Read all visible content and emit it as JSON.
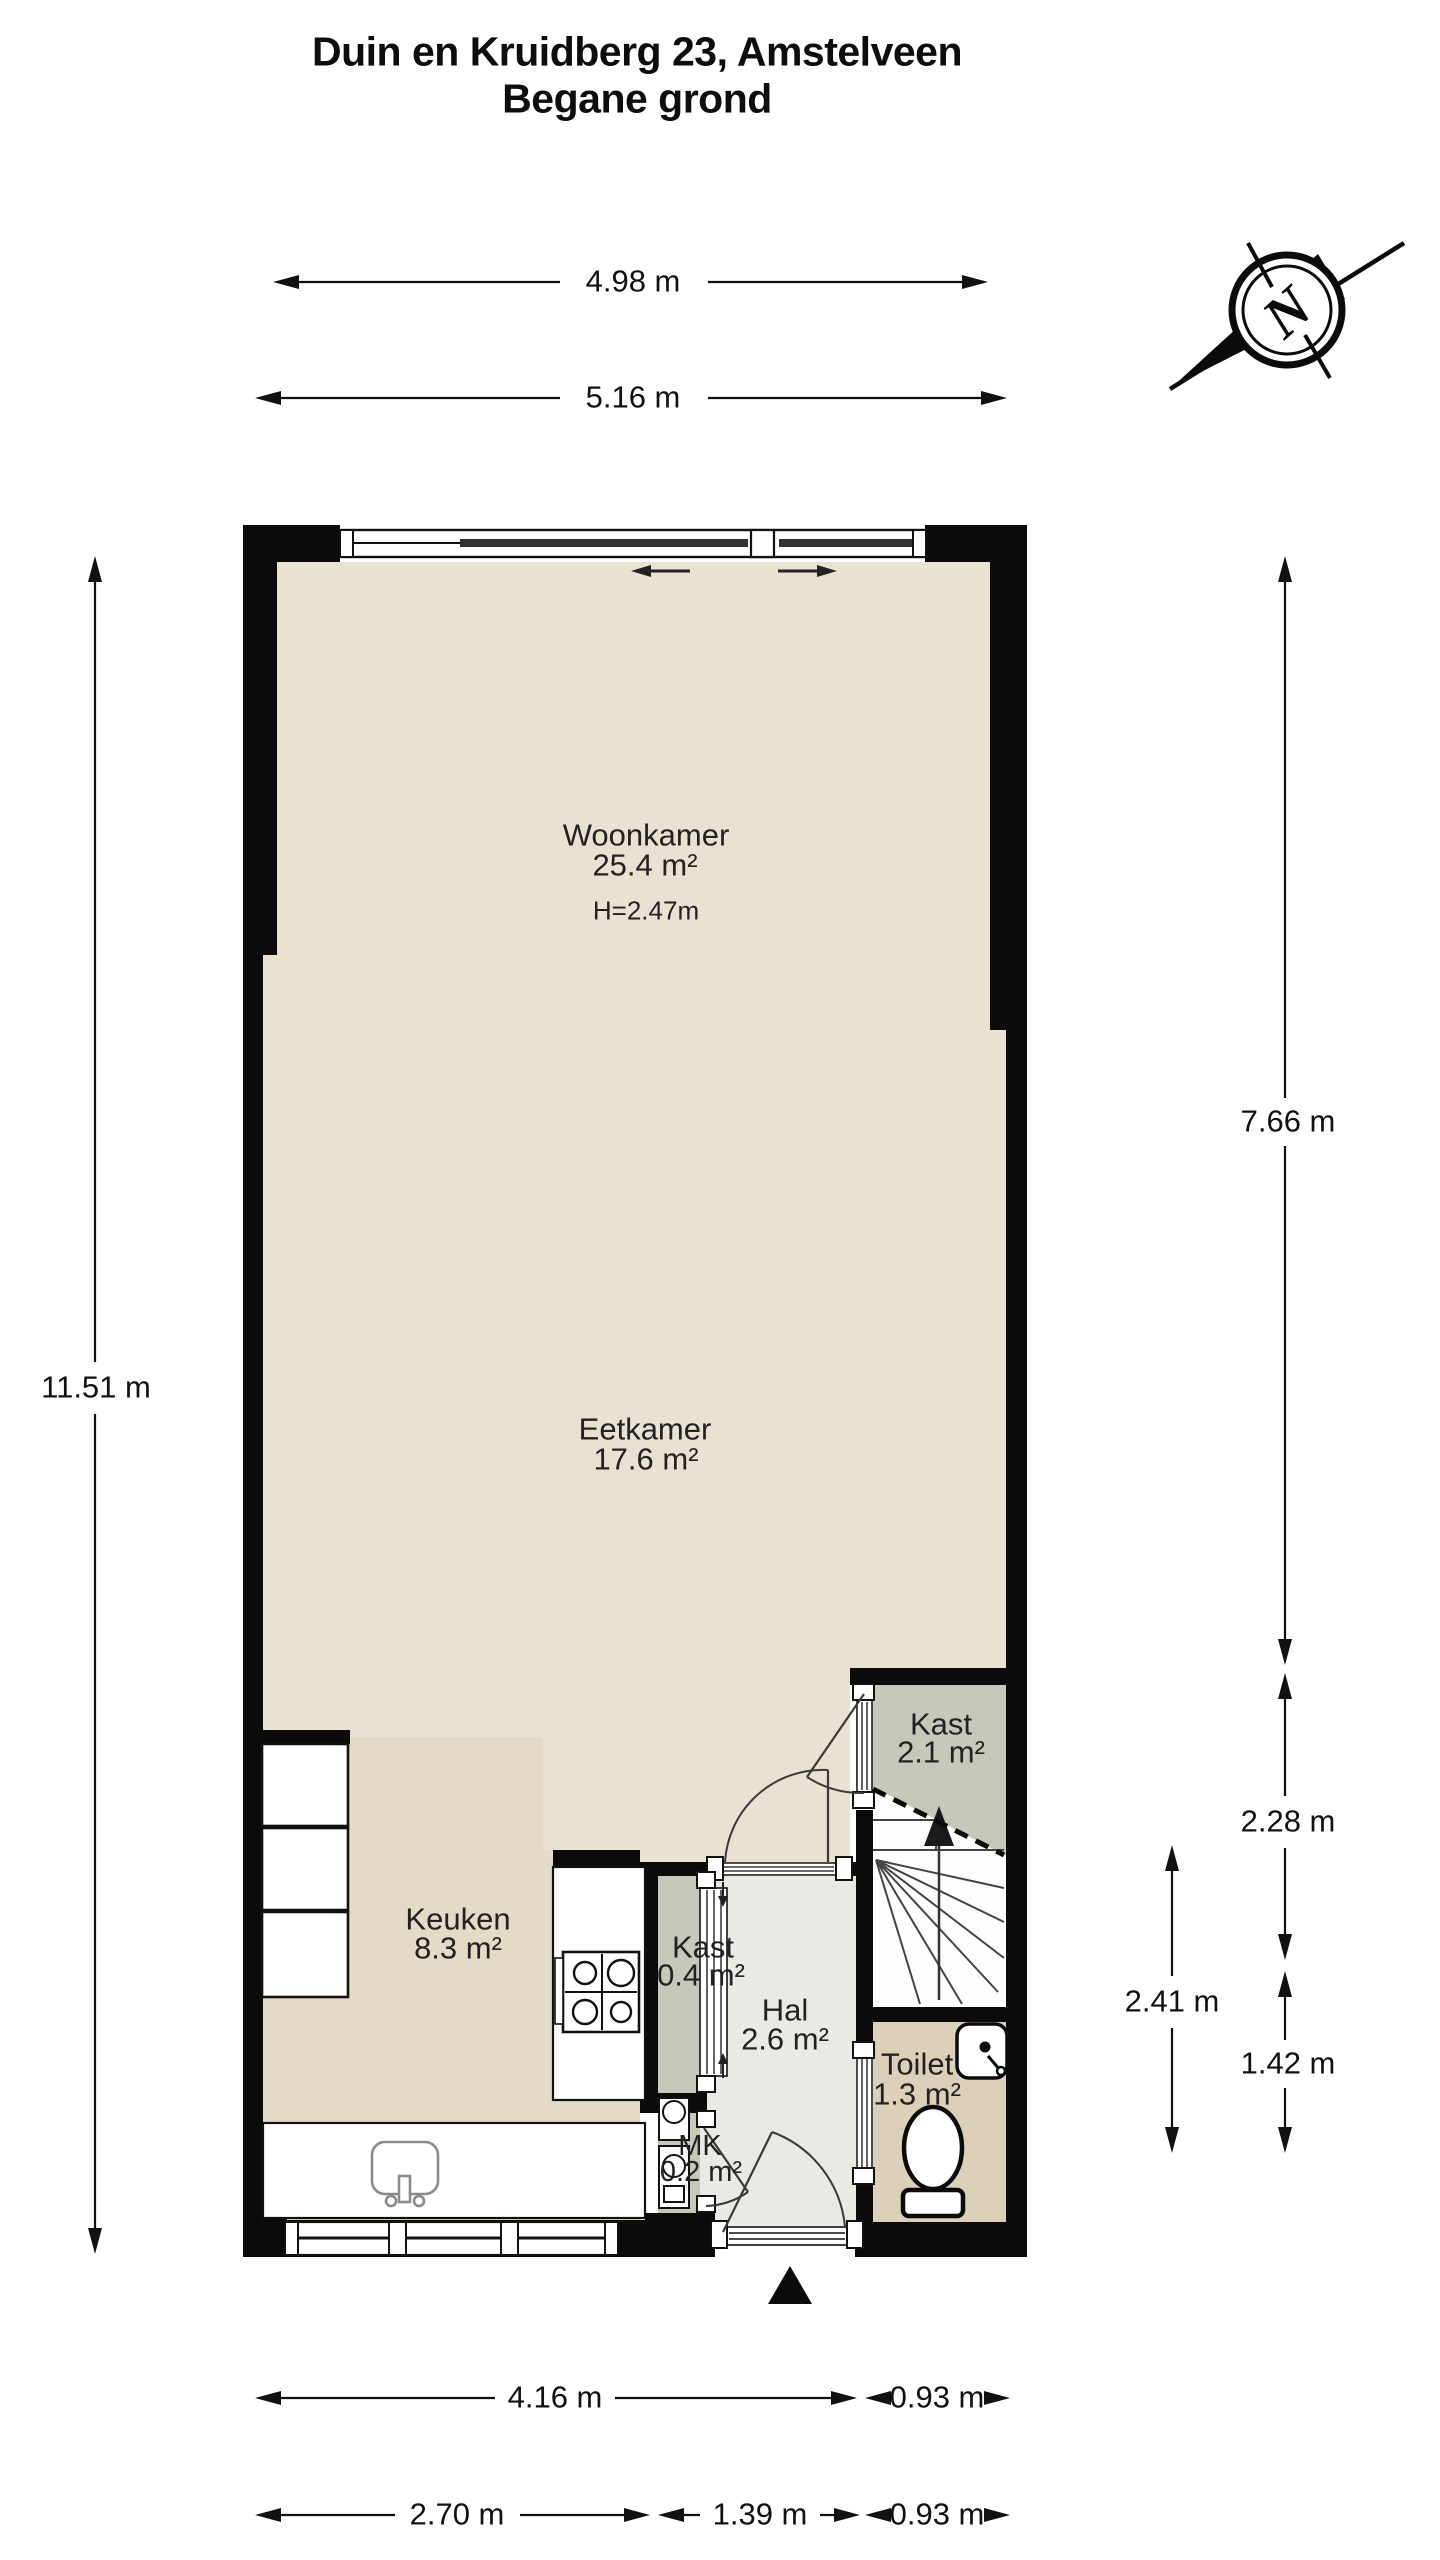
{
  "title": {
    "line1": "Duin en Kruidberg 23, Amstelveen",
    "line2": "Begane grond"
  },
  "compass": {
    "north": "N"
  },
  "rooms": {
    "woonkamer": {
      "name": "Woonkamer",
      "area": "25.4 m²",
      "ceiling_height": "H=2.47m"
    },
    "eetkamer": {
      "name": "Eetkamer",
      "area": "17.6 m²"
    },
    "keuken": {
      "name": "Keuken",
      "area": "8.3 m²"
    },
    "kast_large": {
      "name": "Kast",
      "area": "2.1 m²"
    },
    "kast_small": {
      "name": "Kast",
      "area": "0.4 m²"
    },
    "hal": {
      "name": "Hal",
      "area": "2.6 m²"
    },
    "toilet": {
      "name": "Toilet",
      "area": "1.3 m²"
    },
    "mk": {
      "name": "MK",
      "area": "0.2 m²"
    }
  },
  "dimensions": {
    "top_width_inner": "4.98 m",
    "top_width_outer": "5.16 m",
    "left_height": "11.51 m",
    "right_living_height": "7.66 m",
    "right_closet_height": "2.28 m",
    "right_hall_height": "2.41 m",
    "right_toilet_height": "1.42 m",
    "bottom_kitchen_width": "4.16 m",
    "bottom_entry_width_top": "0.93 m",
    "bottom_kitchen_inner": "2.70 m",
    "bottom_hall_width": "1.39 m",
    "bottom_entry_width": "0.93 m"
  },
  "colors": {
    "wall": "#0b0b0b",
    "floor_main": "#e9e2d2",
    "floor_kitchen": "#e4dbc7",
    "floor_closet": "#c6c9ba",
    "floor_hall": "#ebe9e3",
    "floor_toilet": "#dcd0b8",
    "floor_stairs": "#fdfdfd"
  }
}
